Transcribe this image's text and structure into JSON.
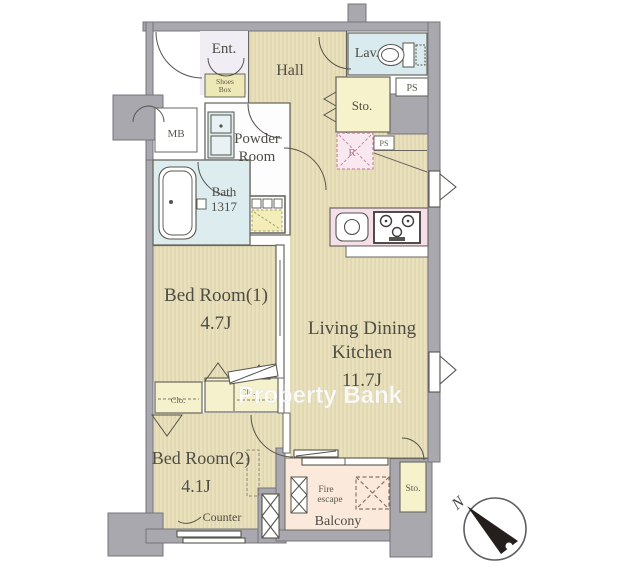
{
  "plan": {
    "rooms": {
      "ent": {
        "label": "Ent."
      },
      "shoes_box": {
        "line1": "Shoes",
        "line2": "Box"
      },
      "hall": {
        "label": "Hall"
      },
      "lav": {
        "label": "Lav."
      },
      "ps_top": {
        "label": "PS"
      },
      "sto_upper": {
        "label": "Sto."
      },
      "mb": {
        "label": "MB"
      },
      "powder_room": {
        "line1": "Powder",
        "line2": "Room"
      },
      "bath": {
        "line1": "Bath",
        "line2": "1317"
      },
      "refrigerator_space": {
        "label": "R"
      },
      "ps_mid": {
        "label": "PS"
      },
      "bedroom1": {
        "label": "Bed Room(1)",
        "size": "4.7J"
      },
      "ldk": {
        "line1": "Living Dining",
        "line2": "Kitchen",
        "size": "11.7J"
      },
      "closet_left": {
        "label": "Clo."
      },
      "closet_right": {
        "label": "Clo."
      },
      "bedroom2": {
        "label": "Bed Room(2)",
        "size": "4.1J"
      },
      "counter": {
        "label": "Counter"
      },
      "fire_escape": {
        "line1": "Fire",
        "line2": "escape"
      },
      "balcony": {
        "label": "Balcony"
      },
      "sto_lower": {
        "label": "Sto."
      }
    },
    "compass": {
      "north_label": "N"
    },
    "watermark": {
      "text": "Property Bank"
    },
    "colors": {
      "wall_gray": "#a9a8ae",
      "wall_edge": "#76757c",
      "floor_beige": "#e9e1bd",
      "floor_stripe": "#dcd3a9",
      "water_blue": "#d9ebee",
      "storage_yellow": "#f6f2cb",
      "kitchen_pink": "#f7dfe9",
      "refrigerator_pink": "#fae8f0",
      "balcony_peach": "#fbe9dc",
      "entrance_lavender": "#f0edf5",
      "line_dark": "#55544c",
      "text_dark": "#4e4d44"
    }
  }
}
